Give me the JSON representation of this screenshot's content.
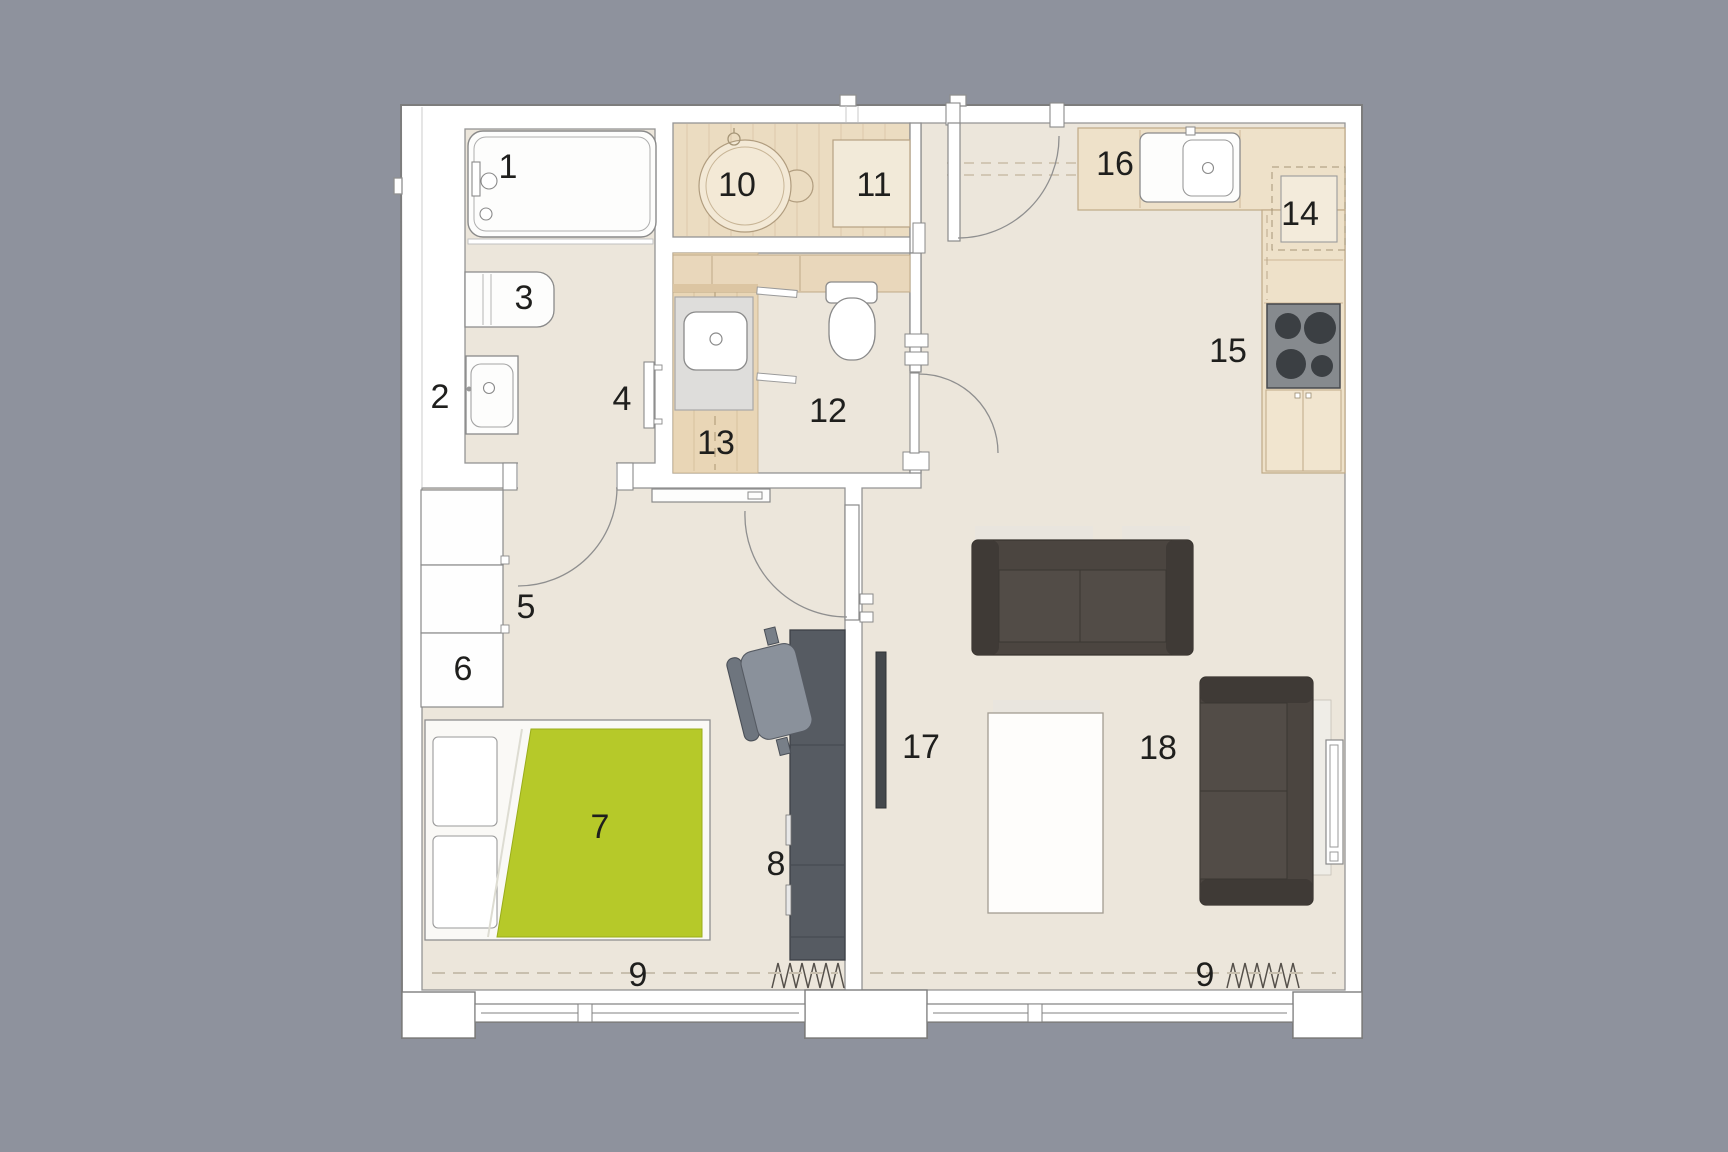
{
  "colors": {
    "background": "#8e929d",
    "wall_white": "#ffffff",
    "plan_outline": "#7d7d7d",
    "floor_beige": "#ece6db",
    "wood_floor": "#ebdcc1",
    "wc_wood": "#e9d6b6",
    "counter_wood": "#eee1c9",
    "counter_outline": "#bfa987",
    "accent_green": "#b6c929",
    "sofa_dark": "#4b4540",
    "sofa_arm": "#3f3a36",
    "desk_gray": "#565b62",
    "chair_gray": "#8a919b",
    "stove_gray": "#868a8e",
    "burner_dark": "#3b3f43",
    "label_text": "#1f1f1d"
  },
  "labels": [
    {
      "name": "bathtub",
      "text": "1"
    },
    {
      "name": "washbasin-bath",
      "text": "2"
    },
    {
      "name": "washing-machine",
      "text": "3"
    },
    {
      "name": "towel-radiator",
      "text": "4"
    },
    {
      "name": "wardrobe",
      "text": "5"
    },
    {
      "name": "cabinet-low",
      "text": "6"
    },
    {
      "name": "bed",
      "text": "7"
    },
    {
      "name": "desk-unit",
      "text": "8"
    },
    {
      "name": "window-bedroom",
      "text": "9"
    },
    {
      "name": "round-table",
      "text": "10"
    },
    {
      "name": "sideboard",
      "text": "11"
    },
    {
      "name": "toilet-room",
      "text": "12"
    },
    {
      "name": "washbasin-wc",
      "text": "13"
    },
    {
      "name": "kitchen-appliance",
      "text": "14"
    },
    {
      "name": "stove",
      "text": "15"
    },
    {
      "name": "kitchen-sink",
      "text": "16"
    },
    {
      "name": "tv",
      "text": "17"
    },
    {
      "name": "living-room",
      "text": "18"
    },
    {
      "name": "window-living",
      "text": "9"
    }
  ]
}
